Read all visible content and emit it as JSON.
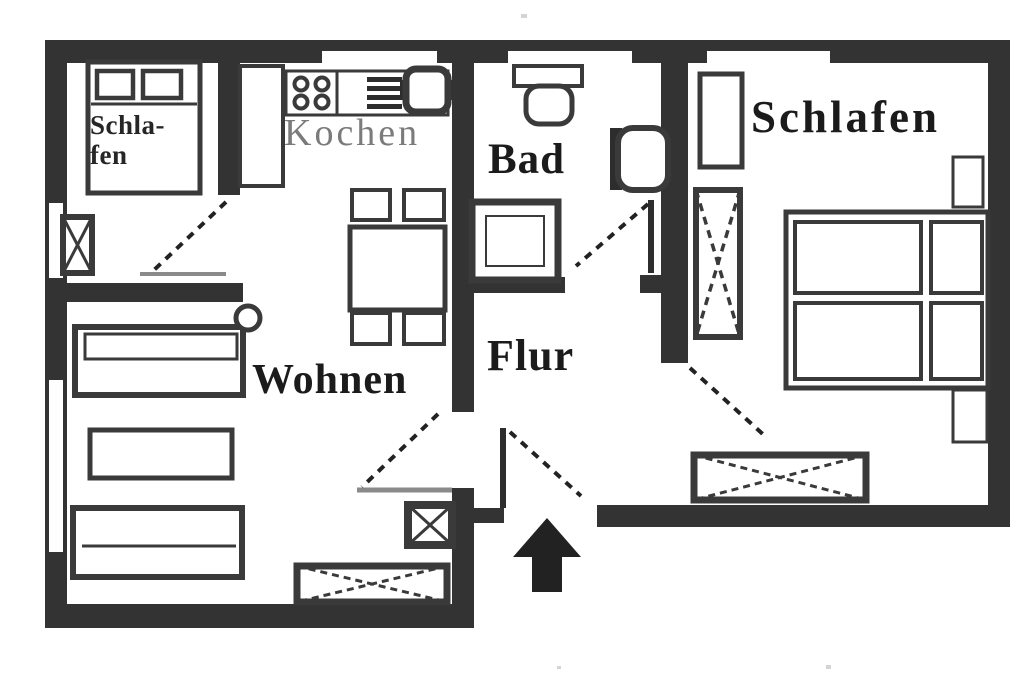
{
  "plan": {
    "rooms": {
      "bedroom_small": {
        "label": "Schla-\nfen"
      },
      "kitchen": {
        "label": "Kochen"
      },
      "bathroom": {
        "label": "Bad"
      },
      "hallway": {
        "label": "Flur"
      },
      "living_room": {
        "label": "Wohnen"
      },
      "bedroom_main": {
        "label": "Schlafen"
      }
    },
    "colors": {
      "wall": "#333333",
      "furniture_line": "#3a3a3a",
      "door_leaf_light": "#8a8a8a",
      "kitchen_label": "#7b7b7b",
      "label_text": "#1b1b1b",
      "background": "#ffffff"
    },
    "icons": {
      "entrance_arrow": "up-arrow",
      "wardrobe_marking": "crossed-diagonals"
    }
  }
}
